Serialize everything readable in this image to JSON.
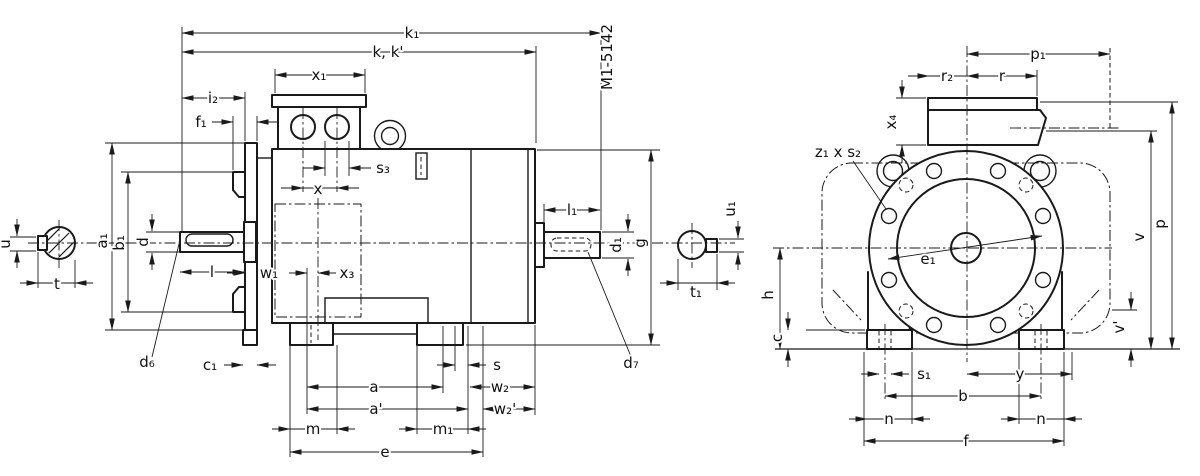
{
  "drawing_number": "M1-5142",
  "labels": {
    "k1": "k₁",
    "kk": "k, k'",
    "x1": "x₁",
    "i2": "i₂",
    "f1": "f₁",
    "s3": "s₃",
    "x": "x",
    "l": "l",
    "w1": "w₁",
    "x3": "x₃",
    "u": "u",
    "t": "t",
    "a1": "a₁",
    "b1": "b₁",
    "d": "d",
    "d6": "d₆",
    "c1": "c₁",
    "s": "s",
    "a": "a",
    "a_prime": "a'",
    "w2": "w₂",
    "w2_prime": "w₂'",
    "m": "m",
    "m1": "m₁",
    "e": "e",
    "l1": "l₁",
    "d1": "d₁",
    "g": "g",
    "t1": "t₁",
    "u1": "u₁",
    "d7": "d₇",
    "p1": "p₁",
    "r2": "r₂",
    "r": "r",
    "x4": "x₄",
    "z1s2": "z₁ x s₂",
    "e1": "e₁",
    "h": "h",
    "c": "c",
    "s1": "s₁",
    "y": "y",
    "b": "b",
    "n_left": "n",
    "n_right": "n",
    "f": "f",
    "v_prime": "v'",
    "v": "v",
    "p": "p"
  }
}
